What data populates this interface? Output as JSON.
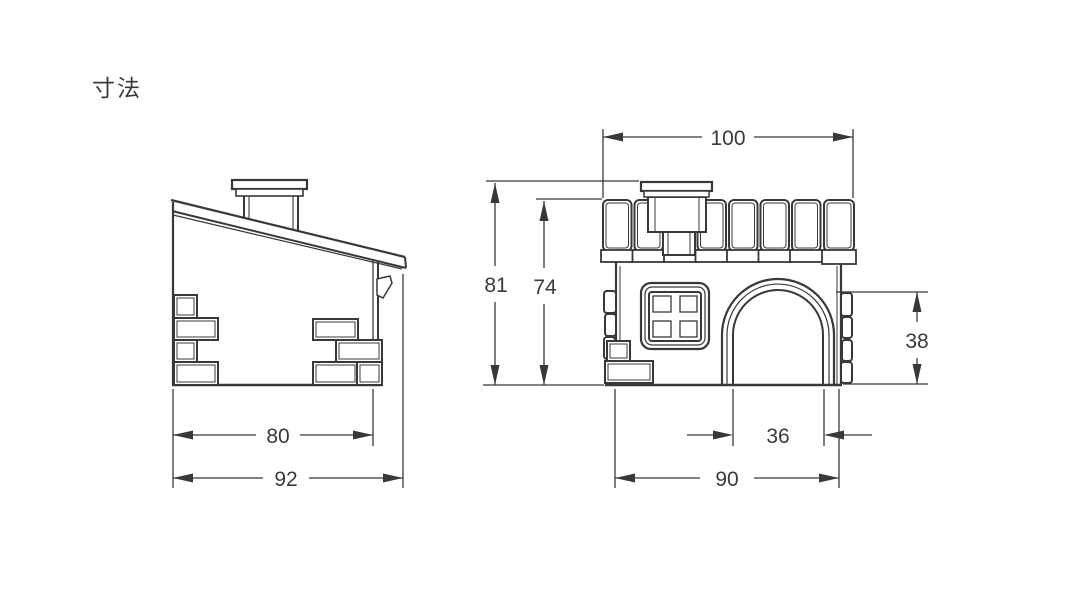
{
  "title": "寸法",
  "side_view": {
    "dim_body_width": "80",
    "dim_overall_width": "92"
  },
  "front_view": {
    "dim_roof_width": "100",
    "dim_overall_height": "81",
    "dim_body_height": "74",
    "dim_door_height": "38",
    "dim_door_width": "36",
    "dim_body_width": "90"
  },
  "colors": {
    "line": "#383838",
    "text": "#3a3a3a",
    "background": "#ffffff"
  }
}
